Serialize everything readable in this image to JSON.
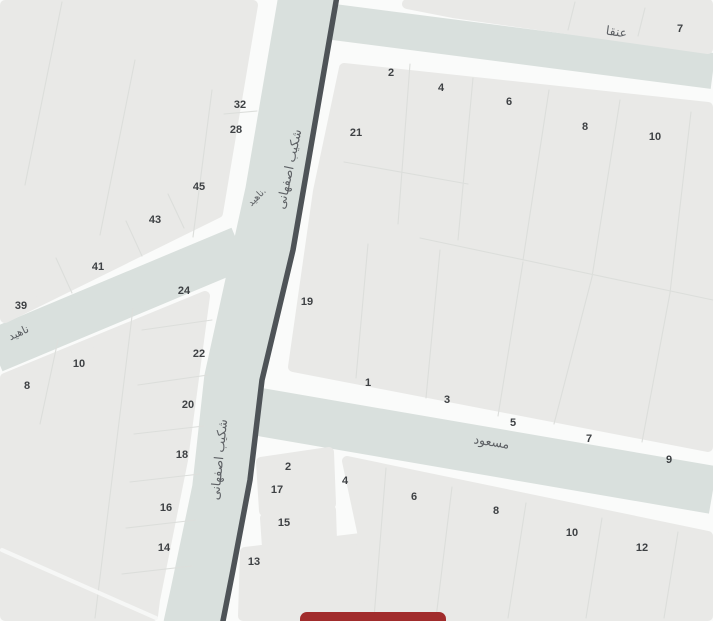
{
  "map": {
    "streets": {
      "shakib_esfahani": "شکیب اصفهانی",
      "nahid": "ناهید",
      "nahid_small": "ناهید.",
      "anqa": "عنقا",
      "masoud": "مسعود"
    },
    "plot_numbers": [
      {
        "label": "32",
        "x": 240,
        "y": 105
      },
      {
        "label": "28",
        "x": 236,
        "y": 130
      },
      {
        "label": "45",
        "x": 199,
        "y": 187
      },
      {
        "label": "43",
        "x": 155,
        "y": 220
      },
      {
        "label": "41",
        "x": 98,
        "y": 267
      },
      {
        "label": "39",
        "x": 21,
        "y": 306
      },
      {
        "label": "24",
        "x": 184,
        "y": 291
      },
      {
        "label": "22",
        "x": 199,
        "y": 354
      },
      {
        "label": "10",
        "x": 79,
        "y": 364
      },
      {
        "label": "8",
        "x": 27,
        "y": 386
      },
      {
        "label": "20",
        "x": 188,
        "y": 405
      },
      {
        "label": "18",
        "x": 182,
        "y": 455
      },
      {
        "label": "16",
        "x": 166,
        "y": 508
      },
      {
        "label": "14",
        "x": 164,
        "y": 548
      },
      {
        "label": "7",
        "x": 680,
        "y": 29
      },
      {
        "label": "2",
        "x": 391,
        "y": 73
      },
      {
        "label": "4",
        "x": 441,
        "y": 88
      },
      {
        "label": "6",
        "x": 509,
        "y": 102
      },
      {
        "label": "8",
        "x": 585,
        "y": 127
      },
      {
        "label": "10",
        "x": 655,
        "y": 137
      },
      {
        "label": "21",
        "x": 356,
        "y": 133
      },
      {
        "label": "19",
        "x": 307,
        "y": 302
      },
      {
        "label": "1",
        "x": 368,
        "y": 383
      },
      {
        "label": "3",
        "x": 447,
        "y": 400
      },
      {
        "label": "5",
        "x": 513,
        "y": 423
      },
      {
        "label": "7",
        "x": 589,
        "y": 439
      },
      {
        "label": "9",
        "x": 669,
        "y": 460
      },
      {
        "label": "2",
        "x": 288,
        "y": 467
      },
      {
        "label": "17",
        "x": 277,
        "y": 490
      },
      {
        "label": "15",
        "x": 284,
        "y": 523
      },
      {
        "label": "13",
        "x": 254,
        "y": 562
      },
      {
        "label": "4",
        "x": 345,
        "y": 481
      },
      {
        "label": "6",
        "x": 414,
        "y": 497
      },
      {
        "label": "8",
        "x": 496,
        "y": 511
      },
      {
        "label": "10",
        "x": 572,
        "y": 533
      },
      {
        "label": "12",
        "x": 642,
        "y": 548
      }
    ],
    "colors": {
      "background": "#fafbfa",
      "block_fill": "#e9e9e7",
      "street_fill": "#d9e0dd",
      "road_line": "#4e5357",
      "marker_red": "#a12c2c",
      "label_gray": "#5d6064",
      "number_gray": "#3e4144"
    }
  }
}
